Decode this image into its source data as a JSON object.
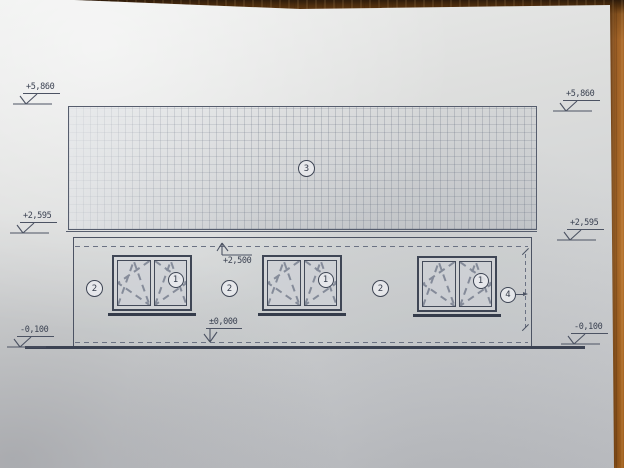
{
  "drawing": {
    "levels": {
      "ridge_left": "+5,860",
      "ridge_right": "+5,860",
      "eaves_left": "+2,595",
      "eaves_right": "+2,595",
      "ground_left": "-0,100",
      "ground_right": "-0,100",
      "ceiling": "+2,500",
      "floor": "±0,000"
    },
    "callouts": {
      "roof": "3",
      "sash": "1",
      "wall": "2",
      "pipe": "4"
    },
    "colors": {
      "line": "#4c5363",
      "paper": "#d8dadb",
      "wood": "#a9682a"
    }
  }
}
